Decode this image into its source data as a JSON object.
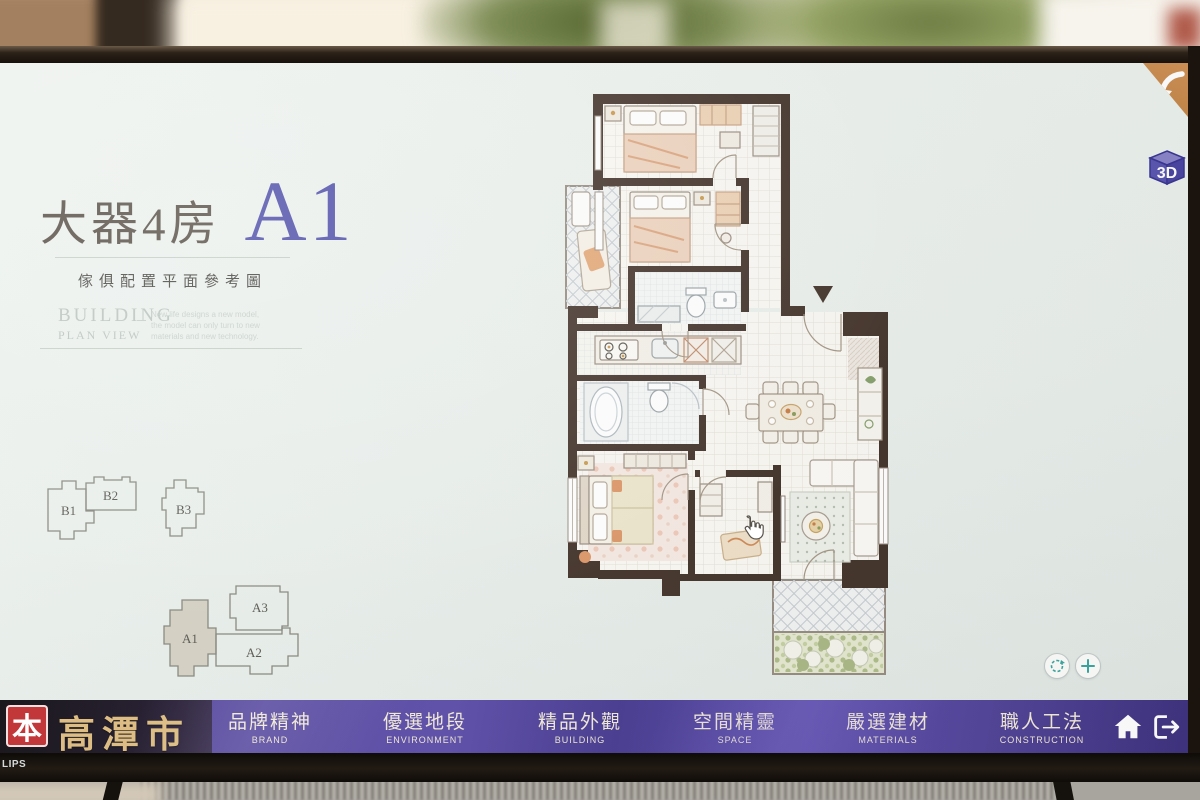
{
  "window": {
    "bezel_logo": "LIPS"
  },
  "screen": {
    "title_zh": "大器4房",
    "title_unit": "A1",
    "subtitle": "傢俱配置平面參考圖",
    "section": {
      "line1": "BUILDING",
      "line2": "PLAN VIEW",
      "note_line1": "New life designs a new model,",
      "note_line2": "the model can only turn to new",
      "note_line3": "materials and new technology."
    },
    "units": {
      "b": [
        "B1",
        "B2",
        "B3"
      ],
      "a": [
        "A1",
        "A2",
        "A3"
      ],
      "selected": "A1"
    },
    "controls": {
      "view3d": "3D"
    }
  },
  "navbar": {
    "logo_badge": "本",
    "logo_name": "高潭市",
    "items": [
      {
        "zh": "品牌精神",
        "en": "BRAND"
      },
      {
        "zh": "優選地段",
        "en": "ENVIRONMENT"
      },
      {
        "zh": "精品外觀",
        "en": "BUILDING"
      },
      {
        "zh": "空間精靈",
        "en": "SPACE"
      },
      {
        "zh": "嚴選建材",
        "en": "MATERIALS"
      },
      {
        "zh": "職人工法",
        "en": "CONSTRUCTION"
      }
    ]
  },
  "colors": {
    "accent_purple": "#5b4ca8",
    "logo_gold": "#dcba7d",
    "badge_red": "#bf2a2c",
    "unit_blue": "#4545a6",
    "wall_brown": "#43332a",
    "control_teal": "#3aa6a0",
    "corner_orange": "#c98a50"
  }
}
